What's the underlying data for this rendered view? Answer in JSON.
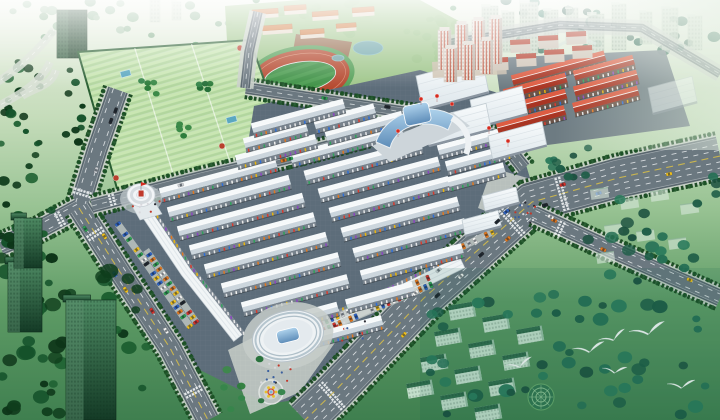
{
  "meta": {
    "width": 720,
    "height": 420,
    "kind": "aerial-architectural-rendering",
    "subject": "master plan bird's-eye rendering of a large wholesale market complex surrounded by roads, campus, residential towers and green belts",
    "visible_text": "none"
  },
  "palette": {
    "road": "#5f6c74",
    "road_inner": "#6e7b84",
    "sidewalk": "#c9cfc9",
    "hedge": "#17461f",
    "bush": "#1c5226",
    "roof_hi": "#f6f9fa",
    "roof_lo": "#ccd6dd",
    "facade": "#77828c",
    "red_roof_hi": "#dd5c42",
    "red_roof_lo": "#a93523",
    "red_facade": "#6b5348",
    "glass_hi": "#aed2ec",
    "glass_lo": "#5d8cb8",
    "lawn": "#9cc487",
    "track_red": "#b5492f",
    "field_green": "#3f9146",
    "water": "#6fa6ad",
    "accent_red": "#c0392b",
    "accent_yellow": "#e8c02a",
    "bird_white": "#ffffff",
    "market_ground": "#5d6d7a",
    "plaza_pave": "#c2c9c4"
  },
  "car_colors": [
    "#d8322a",
    "#f2c21e",
    "#f4f4f2",
    "#23282e",
    "#2e63c4",
    "#2fa052",
    "#c8ccd0",
    "#e07820"
  ],
  "tick_colors": [
    "#d63b2f",
    "#2f6fd6",
    "#e8b50f",
    "#2fa05a",
    "#e8e8e8",
    "#8a46c0",
    "#e07820",
    "#f2f2f0"
  ],
  "veg_palettes": {
    "dark": [
      "#0f3d1c",
      "#14522a",
      "#1b5e2f",
      "#0d3518"
    ],
    "mid": [
      "#2e7d3c",
      "#3c8a48",
      "#27703a",
      "#35854a"
    ],
    "teal": [
      "#1d5c46",
      "#267055",
      "#1a4f3e",
      "#2a7a5b"
    ],
    "haze": [
      "#7ba883",
      "#8fb795",
      "#a3c3a6"
    ]
  },
  "vegetation": [
    {
      "x": 0,
      "y": 0,
      "w": 250,
      "h": 38,
      "n": 22,
      "r": [
        3,
        6
      ],
      "pal": "haze",
      "layer": "pre"
    },
    {
      "x": 250,
      "y": 0,
      "w": 230,
      "h": 34,
      "n": 20,
      "r": [
        3,
        6
      ],
      "pal": "mid",
      "layer": "pre"
    },
    {
      "x": 480,
      "y": 0,
      "w": 240,
      "h": 52,
      "n": 26,
      "r": [
        3,
        7
      ],
      "pal": "teal",
      "layer": "pre"
    },
    {
      "x": 0,
      "y": 55,
      "w": 42,
      "h": 120,
      "n": 20,
      "r": [
        3,
        6
      ],
      "pal": "dark",
      "layer": "pre"
    },
    {
      "x": 58,
      "y": 38,
      "w": 26,
      "h": 110,
      "n": 12,
      "r": [
        3,
        5
      ],
      "pal": "dark",
      "layer": "pre"
    },
    {
      "x": 190,
      "y": 42,
      "w": 46,
      "h": 66,
      "n": 12,
      "r": [
        3,
        5
      ],
      "pal": "mid",
      "layer": "pre"
    },
    {
      "x": 240,
      "y": 96,
      "w": 120,
      "h": 26,
      "n": 9,
      "r": [
        3,
        5
      ],
      "pal": "mid",
      "layer": "pre"
    },
    {
      "x": 415,
      "y": 18,
      "w": 62,
      "h": 42,
      "n": 10,
      "r": [
        3,
        6
      ],
      "pal": "mid",
      "layer": "pre"
    },
    {
      "x": 100,
      "y": 150,
      "w": 200,
      "h": 44,
      "n": 24,
      "r": [
        3,
        5
      ],
      "pal": "mid",
      "layer": "pre"
    },
    {
      "x": 0,
      "y": 178,
      "w": 58,
      "h": 84,
      "n": 16,
      "r": [
        4,
        7
      ],
      "pal": "dark",
      "layer": "post"
    },
    {
      "x": 0,
      "y": 250,
      "w": 150,
      "h": 168,
      "n": 52,
      "r": [
        4,
        9
      ],
      "pal": "dark",
      "layer": "post"
    },
    {
      "x": 575,
      "y": 172,
      "w": 145,
      "h": 112,
      "n": 24,
      "r": [
        4,
        7
      ],
      "pal": "teal",
      "layer": "post"
    },
    {
      "x": 430,
      "y": 288,
      "w": 290,
      "h": 130,
      "n": 48,
      "r": [
        4,
        8
      ],
      "pal": "teal",
      "layer": "post"
    },
    {
      "x": 540,
      "y": 148,
      "w": 56,
      "h": 40,
      "n": 9,
      "r": [
        3,
        5
      ],
      "pal": "teal",
      "layer": "post"
    },
    {
      "x": 222,
      "y": 352,
      "w": 70,
      "h": 60,
      "n": 8,
      "r": [
        3,
        5
      ],
      "pal": "mid",
      "layer": "post"
    }
  ],
  "city_towers": [
    [
      482,
      6,
      16,
      46,
      0.85
    ],
    [
      502,
      12,
      12,
      40,
      0.8
    ],
    [
      520,
      2,
      18,
      52,
      0.9
    ],
    [
      544,
      10,
      14,
      42,
      0.85
    ],
    [
      566,
      8,
      12,
      36,
      0.75
    ],
    [
      588,
      14,
      16,
      40,
      0.85
    ],
    [
      612,
      4,
      14,
      46,
      0.85
    ],
    [
      640,
      12,
      12,
      32,
      0.75
    ],
    [
      662,
      8,
      16,
      42,
      0.8
    ],
    [
      688,
      16,
      14,
      34,
      0.75
    ],
    [
      305,
      0,
      12,
      26,
      0.5
    ],
    [
      330,
      2,
      10,
      22,
      0.45
    ],
    [
      360,
      0,
      12,
      24,
      0.5
    ],
    [
      150,
      0,
      10,
      22,
      0.4
    ],
    [
      172,
      2,
      9,
      18,
      0.38
    ]
  ],
  "tl_tower": [
    57,
    10,
    30,
    48
  ],
  "ramp_curves": [
    "M-6,108 C18,96 40,84 50,62",
    "M-6,84 C14,72 34,56 54,30",
    "M22,96 C34,88 52,86 56,70"
  ],
  "campus": {
    "lawn": [
      [
        225,
        6
      ],
      [
        300,
        0
      ],
      [
        420,
        0
      ],
      [
        468,
        26
      ],
      [
        472,
        92
      ],
      [
        430,
        112
      ],
      [
        330,
        102
      ],
      [
        252,
        96
      ],
      [
        228,
        58
      ]
    ],
    "dirt": [
      [
        296,
        34
      ],
      [
        352,
        42
      ],
      [
        346,
        66
      ],
      [
        292,
        57
      ]
    ],
    "track": {
      "cx": 300,
      "cy": 77,
      "rot": -9,
      "rx": 50,
      "ry": 27
    },
    "ponds": [
      [
        368,
        48,
        15,
        7
      ],
      [
        338,
        58,
        6,
        3
      ]
    ],
    "buildings": [
      [
        252,
        10,
        26,
        9
      ],
      [
        284,
        6,
        22,
        9
      ],
      [
        312,
        12,
        26,
        9
      ],
      [
        262,
        26,
        30,
        9
      ],
      [
        300,
        30,
        24,
        9
      ],
      [
        336,
        24,
        20,
        8
      ],
      [
        352,
        8,
        22,
        9
      ]
    ]
  },
  "green_complex": {
    "outline": [
      [
        78,
        52
      ],
      [
        250,
        40
      ],
      [
        288,
        148
      ],
      [
        118,
        192
      ]
    ],
    "courtyards": [
      [
        150,
        88,
        12
      ],
      [
        205,
        84,
        10
      ],
      [
        186,
        130,
        11
      ]
    ],
    "pools": [
      [
        120,
        72
      ],
      [
        226,
        118
      ]
    ],
    "accents": [
      [
        116,
        178
      ],
      [
        222,
        146
      ],
      [
        262,
        136
      ],
      [
        240,
        48
      ]
    ]
  },
  "market_ground": [
    [
      92,
      210
    ],
    [
      246,
      156
    ],
    [
      254,
      106
    ],
    [
      420,
      70
    ],
    [
      505,
      95
    ],
    [
      536,
      198
    ],
    [
      426,
      300
    ],
    [
      334,
      394
    ],
    [
      268,
      404
    ],
    [
      196,
      368
    ]
  ],
  "red_ground": [
    [
      495,
      58
    ],
    [
      665,
      50
    ],
    [
      690,
      126
    ],
    [
      540,
      146
    ],
    [
      505,
      132
    ]
  ],
  "plazas": [
    [
      [
        228,
        350
      ],
      [
        312,
        308
      ],
      [
        344,
        330
      ],
      [
        300,
        392
      ],
      [
        250,
        414
      ]
    ],
    [
      [
        492,
        168
      ],
      [
        556,
        186
      ],
      [
        540,
        232
      ],
      [
        478,
        208
      ]
    ]
  ],
  "market_rows": [
    [
      160,
      193,
      250
    ],
    [
      168,
      212,
      262
    ],
    [
      178,
      231,
      270
    ],
    [
      190,
      250,
      268
    ],
    [
      205,
      269,
      262
    ],
    [
      222,
      288,
      252
    ],
    [
      242,
      307,
      228
    ],
    [
      268,
      325,
      150
    ],
    [
      295,
      343,
      90
    ],
    [
      236,
      160,
      172
    ],
    [
      244,
      143,
      135
    ],
    [
      252,
      128,
      95
    ],
    [
      438,
      150,
      70
    ],
    [
      446,
      166,
      66
    ],
    [
      448,
      182,
      58
    ]
  ],
  "red_rows": [
    [
      512,
      80,
      96
    ],
    [
      504,
      94,
      134
    ],
    [
      500,
      111,
      142
    ],
    [
      497,
      128,
      146
    ]
  ],
  "halls": [
    [
      416,
      76,
      66,
      34,
      1
    ],
    [
      470,
      100,
      52,
      28,
      1
    ],
    [
      424,
      120,
      62,
      26,
      1
    ],
    [
      488,
      136,
      54,
      24,
      1
    ],
    [
      648,
      88,
      44,
      26,
      0.55
    ],
    [
      482,
      196,
      34,
      16,
      1
    ],
    [
      462,
      220,
      36,
      16,
      1
    ]
  ],
  "pink_towers": {
    "podium": [
      432,
      62,
      74,
      16
    ],
    "towers": [
      [
        438,
        30,
        13,
        40
      ],
      [
        455,
        24,
        13,
        46
      ],
      [
        472,
        20,
        13,
        50
      ],
      [
        489,
        18,
        13,
        46
      ],
      [
        444,
        48,
        13,
        34
      ],
      [
        462,
        44,
        13,
        36
      ],
      [
        480,
        40,
        13,
        34
      ]
    ]
  },
  "red_apartments": [
    [
      482,
      44
    ],
    [
      510,
      40
    ],
    [
      538,
      36
    ],
    [
      566,
      32
    ],
    [
      488,
      58
    ],
    [
      516,
      54
    ],
    [
      544,
      50
    ],
    [
      572,
      46
    ]
  ],
  "roads": [
    {
      "name": "west-avenue",
      "pts": [
        [
          118,
          90
        ],
        [
          97,
          150
        ],
        [
          79,
          208
        ]
      ],
      "w": 19,
      "lanes": [
        0.5
      ],
      "center": false,
      "hedges": true,
      "cars": 3
    },
    {
      "name": "west-exit",
      "pts": [
        [
          79,
          208
        ],
        [
          38,
          230
        ],
        [
          0,
          246
        ]
      ],
      "w": 17,
      "lanes": [
        0.5
      ],
      "center": false,
      "hedges": true,
      "cars": 2
    },
    {
      "name": "southwest-boulevard",
      "pts": [
        [
          79,
          208
        ],
        [
          120,
          272
        ],
        [
          170,
          348
        ],
        [
          208,
          420
        ]
      ],
      "w": 21,
      "lanes": [
        0.5
      ],
      "center": true,
      "hedges": true,
      "cars": 6
    },
    {
      "name": "market-north-road",
      "pts": [
        [
          92,
          206
        ],
        [
          200,
          178
        ],
        [
          310,
          152
        ],
        [
          430,
          120
        ],
        [
          500,
          138
        ],
        [
          524,
          168
        ]
      ],
      "w": 12,
      "lanes": [],
      "center": false,
      "hedges": true,
      "cars": 3
    },
    {
      "name": "campus-south-road",
      "pts": [
        [
          246,
          88
        ],
        [
          350,
          104
        ],
        [
          430,
          116
        ]
      ],
      "w": 10,
      "lanes": [],
      "center": false,
      "hedges": true,
      "cars": 2
    },
    {
      "name": "campus-west-road",
      "pts": [
        [
          258,
          12
        ],
        [
          249,
          52
        ],
        [
          245,
          88
        ]
      ],
      "w": 8,
      "lanes": [],
      "center": false,
      "hedges": false,
      "cars": 0
    },
    {
      "name": "main-avenue",
      "pts": [
        [
          720,
          156
        ],
        [
          618,
          178
        ],
        [
          532,
          202
        ],
        [
          424,
          298
        ],
        [
          334,
          392
        ],
        [
          305,
          420
        ]
      ],
      "w": 38,
      "lanes": [
        0.3,
        0.62
      ],
      "center": true,
      "hedges": true,
      "cars": 13
    },
    {
      "name": "east-road",
      "pts": [
        [
          534,
          214
        ],
        [
          612,
          250
        ],
        [
          670,
          276
        ],
        [
          720,
          298
        ]
      ],
      "w": 15,
      "lanes": [
        0.5
      ],
      "center": false,
      "hedges": true,
      "cars": 4
    },
    {
      "name": "city-ring-road",
      "pts": [
        [
          444,
          44
        ],
        [
          560,
          25
        ],
        [
          642,
          28
        ],
        [
          720,
          74
        ]
      ],
      "w": 7,
      "lanes": [],
      "center": false,
      "hedges": false,
      "cars": 0,
      "opacity": 0.75
    }
  ],
  "crosswalks": [
    [
      83,
      193,
      107,
      17
    ],
    [
      95,
      234,
      57,
      19
    ],
    [
      112,
      200,
      -15,
      12
    ],
    [
      60,
      219,
      152,
      15
    ],
    [
      562,
      194,
      164,
      34
    ],
    [
      512,
      222,
      138,
      34
    ],
    [
      560,
      228,
      25,
      14
    ],
    [
      332,
      396,
      138,
      34
    ],
    [
      193,
      392,
      62,
      19
    ]
  ],
  "parking": [
    {
      "a": [
        146,
        250
      ],
      "b": [
        196,
        322
      ],
      "rows": 2
    },
    {
      "a": [
        305,
        330
      ],
      "b": [
        428,
        278
      ],
      "rows": 2
    },
    {
      "a": [
        118,
        224
      ],
      "b": [
        144,
        260
      ],
      "rows": 1
    },
    {
      "a": [
        452,
        252
      ],
      "b": [
        492,
        232
      ],
      "rows": 1
    }
  ],
  "malls": [
    {
      "pts": [
        [
          147,
          214
        ],
        [
          186,
          272
        ],
        [
          238,
          338
        ]
      ],
      "w": 11
    },
    {
      "pts": [
        [
          316,
          330
        ],
        [
          392,
          296
        ],
        [
          462,
          262
        ]
      ],
      "w": 13
    }
  ],
  "landmarks": {
    "drum": {
      "cx": 141,
      "cy": 195
    },
    "blue_glass": {
      "balloons": [
        [
          398,
          131
        ],
        [
          421,
          99
        ],
        [
          437,
          96
        ],
        [
          452,
          104
        ],
        [
          489,
          128
        ],
        [
          508,
          141
        ]
      ]
    },
    "oval": {
      "cx": 288,
      "cy": 336,
      "rot": -14
    },
    "roundabout": {
      "cx": 271,
      "cy": 392
    },
    "garden_circle": {
      "cx": 541,
      "cy": 397
    }
  },
  "green_towers": [
    [
      66,
      300,
      50,
      120
    ],
    [
      8,
      262,
      34,
      70
    ],
    [
      14,
      218,
      28,
      50
    ]
  ],
  "se_apartments": {
    "base": [
      448,
      306
    ],
    "ca": [
      34,
      12
    ],
    "cb": [
      -14,
      26
    ],
    "cols": 3,
    "rows": 4,
    "w": 26,
    "h": 15,
    "rot": -10
  },
  "right_residences": [
    [
      590,
      190
    ],
    [
      620,
      200
    ],
    [
      650,
      192
    ],
    [
      680,
      205
    ],
    [
      604,
      226
    ],
    [
      636,
      232
    ],
    [
      668,
      240
    ],
    [
      596,
      254
    ]
  ],
  "people": [
    {
      "x": 520,
      "y": 212,
      "n": 16
    },
    {
      "x": 276,
      "y": 372,
      "n": 14
    },
    {
      "x": 145,
      "y": 210,
      "n": 8
    },
    {
      "x": 352,
      "y": 330,
      "n": 10
    }
  ],
  "birds": [
    [
      520,
      367,
      1.0,
      -10
    ],
    [
      590,
      352,
      1.15,
      -5
    ],
    [
      614,
      340,
      1.0,
      -15
    ],
    [
      615,
      373,
      0.88,
      6
    ],
    [
      649,
      334,
      1.3,
      -8
    ],
    [
      682,
      388,
      1.0,
      0
    ]
  ]
}
